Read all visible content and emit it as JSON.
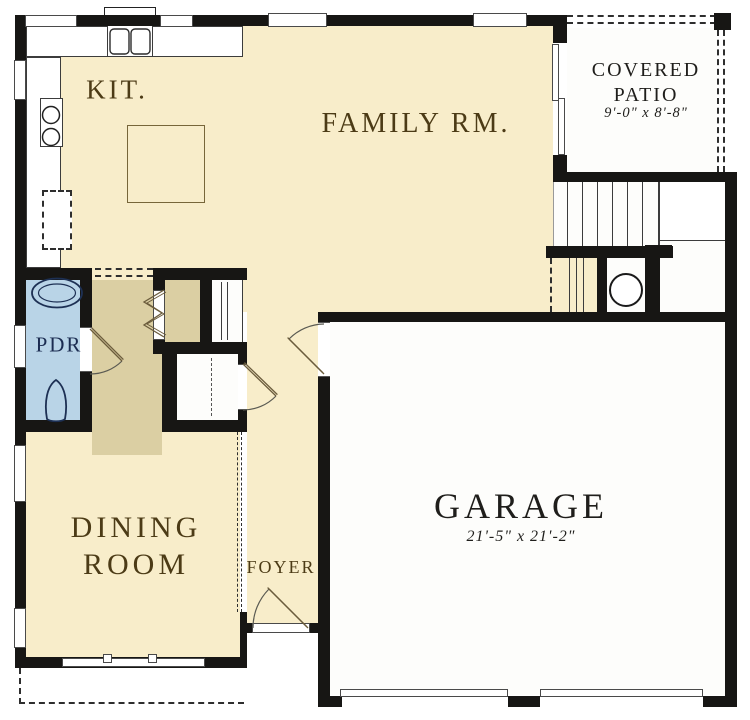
{
  "plan": {
    "type": "first-floor-plan",
    "colors": {
      "floor_cream": "#f8edca",
      "floor_tan": "#dbcfa3",
      "floor_blue": "#b9d4e7",
      "wall": "#171614",
      "label_brown": "#4c3b16",
      "label_dark": "#1f1e1b",
      "label_navy": "#1b2c51"
    },
    "rooms": {
      "kitchen": {
        "label": "KIT."
      },
      "family_room": {
        "label": "FAMILY RM."
      },
      "covered_patio": {
        "label_line1": "COVERED",
        "label_line2": "PATIO",
        "dimensions": "9'-0\" x 8'-8\""
      },
      "powder_room": {
        "label": "PDR"
      },
      "dining_room": {
        "label_line1": "DINING",
        "label_line2": "ROOM"
      },
      "foyer": {
        "label": "FOYER"
      },
      "garage": {
        "label": "GARAGE",
        "dimensions": "21'-5\" x 21'-2\""
      }
    },
    "fixtures": {
      "kitchen_sink": "double-basin-sink",
      "cooktop": "two-burner-cooktop",
      "refrigerator": "refrigerator-recess",
      "island": "kitchen-island",
      "powder_sink": "oval-lavatory",
      "toilet": "toilet",
      "water_heater": "water-heater",
      "stairs": "staircase",
      "sliding_door": "sliding-glass-door",
      "garage_doors": "double-garage-doors",
      "front_door": "front-entry-door"
    }
  }
}
